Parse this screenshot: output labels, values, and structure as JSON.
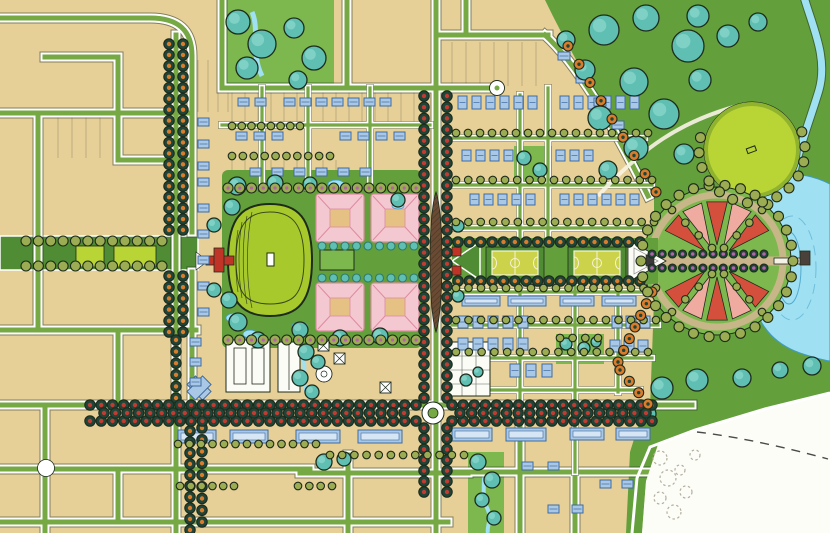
{
  "map": {
    "type": "illustrated-master-plan",
    "features": [
      {
        "name": "street-grid",
        "color": "street"
      },
      {
        "name": "tree-lined-main-avenue",
        "color": "tree_dark"
      },
      {
        "name": "great-lawn-oval",
        "color": "oval"
      },
      {
        "name": "civic-campus-pink-buildings",
        "color": "pink"
      },
      {
        "name": "west-boulevard-green",
        "color": "park_dark"
      },
      {
        "name": "east-mall-sports-courts",
        "color": "court"
      },
      {
        "name": "radial-parterre-garden-circle",
        "color": "garden_red"
      },
      {
        "name": "lake-with-pier",
        "color": "lake"
      },
      {
        "name": "great-park-tree-masses",
        "color": "teal"
      },
      {
        "name": "lawn-circle",
        "color": "lawn"
      },
      {
        "name": "stream",
        "color": "lake"
      },
      {
        "name": "roundabout",
        "color": "street"
      },
      {
        "name": "residential-blocks-blue-buildings",
        "color": "bldg_blue"
      },
      {
        "name": "undeveloped-parcel-pencil-sketch",
        "color": "white_area"
      }
    ]
  },
  "palette": {
    "paper": "#e7d098",
    "street": "#76a844",
    "park": "#63a03c",
    "park_dark": "#4f8c33",
    "park_light": "#7cb84d",
    "lawn": "#b9d435",
    "oval": "#a8c92c",
    "oval_ring": "#8fb22f",
    "teal": "#5fbfb2",
    "teal_dark": "#2c7a6e",
    "ink": "#1e2b1c",
    "tree_dark": "#1f4438",
    "tree_red": "#c23b31",
    "tree_orange": "#d97c2b",
    "tree_olive": "#9cac52",
    "tree_magenta": "#b363a8",
    "bldg_blue": "#a9c8e6",
    "bldg_blue_dark": "#3f6a9e",
    "bldg_blue_light": "#d6e6f5",
    "bldg_white": "#fcfcf6",
    "pink": "#f4c8d1",
    "pink_dark": "#dd8ba0",
    "courtyard": "#e5c183",
    "court": "#ccd24a",
    "cream": "#f6f3da",
    "lake": "#9fe1f2",
    "lake_line": "#3f9cc4",
    "path_tan": "#cbb58a",
    "median": "#6b4a33",
    "gate_red": "#c03427",
    "white_area": "#fdfdf8",
    "sketch": "#b5ae9e",
    "garden_red": "#d5503c",
    "garden_pink": "#efab9f"
  },
  "tree_rows": [
    [
      "ao",
      169,
      44,
      169,
      230,
      18
    ],
    [
      "ao",
      183,
      44,
      183,
      230,
      18
    ],
    [
      "ao",
      169,
      276,
      169,
      332,
      6
    ],
    [
      "ao",
      183,
      276,
      183,
      332,
      6
    ],
    [
      "ao",
      176,
      340,
      176,
      398,
      6
    ],
    [
      "ao",
      190,
      420,
      190,
      530,
      11
    ],
    [
      "ao",
      202,
      428,
      202,
      522,
      9
    ],
    [
      "ar",
      424,
      96,
      424,
      398,
      28
    ],
    [
      "ar",
      447,
      96,
      447,
      398,
      28
    ],
    [
      "ar",
      424,
      428,
      424,
      492,
      7
    ],
    [
      "ar",
      447,
      428,
      447,
      492,
      7
    ],
    [
      "ar",
      90,
      405,
      416,
      405,
      30
    ],
    [
      "ar",
      90,
      421,
      416,
      421,
      30
    ],
    [
      "ar",
      104,
      413,
      404,
      413,
      27
    ],
    [
      "ar",
      452,
      405,
      652,
      405,
      19
    ],
    [
      "ar",
      452,
      421,
      652,
      421,
      19
    ],
    [
      "ar",
      460,
      413,
      646,
      413,
      17
    ],
    [
      "ao",
      458,
      242,
      640,
      242,
      17
    ],
    [
      "ao",
      458,
      281,
      640,
      281,
      17
    ],
    [
      "om",
      228,
      188,
      416,
      188,
      17
    ],
    [
      "om",
      228,
      340,
      416,
      340,
      17
    ],
    [
      "ol",
      26,
      241,
      162,
      241,
      12
    ],
    [
      "ol",
      26,
      266,
      162,
      266,
      12
    ],
    [
      "tm",
      322,
      246,
      414,
      246,
      9
    ],
    [
      "tm",
      322,
      278,
      414,
      278,
      9
    ],
    [
      "mg",
      652,
      254,
      764,
      254,
      12
    ],
    [
      "mg",
      652,
      268,
      764,
      268,
      12
    ],
    [
      "sm",
      232,
      126,
      300,
      126,
      8
    ],
    [
      "sm",
      232,
      156,
      330,
      156,
      10
    ],
    [
      "sm",
      178,
      444,
      316,
      444,
      13
    ],
    [
      "sm",
      330,
      455,
      464,
      455,
      12
    ],
    [
      "sm",
      180,
      486,
      234,
      486,
      6
    ],
    [
      "sm",
      298,
      486,
      332,
      486,
      4
    ],
    [
      "sm",
      456,
      133,
      648,
      133,
      17
    ],
    [
      "sm",
      456,
      180,
      652,
      180,
      17
    ],
    [
      "sm",
      456,
      222,
      654,
      222,
      17
    ],
    [
      "sm",
      456,
      288,
      656,
      288,
      17
    ],
    [
      "sm",
      456,
      320,
      656,
      320,
      17
    ],
    [
      "sm",
      456,
      352,
      648,
      352,
      16
    ],
    [
      "or",
      568,
      46,
      656,
      192,
      9
    ],
    [
      "or",
      652,
      292,
      618,
      362,
      7
    ],
    [
      "or",
      620,
      370,
      648,
      404,
      4
    ],
    [
      "sm",
      672,
      210,
      712,
      248,
      4
    ],
    [
      "sm",
      762,
      210,
      724,
      248,
      4
    ],
    [
      "sm",
      672,
      312,
      712,
      274,
      4
    ],
    [
      "sm",
      762,
      312,
      724,
      274,
      4
    ],
    [
      "sm",
      560,
      338,
      598,
      338,
      4
    ]
  ],
  "tree_rings": [
    [
      "ol",
      717,
      261,
      76,
      30,
      0,
      360
    ],
    [
      "ol",
      752,
      150,
      53,
      14,
      -20,
      210
    ]
  ],
  "tree_clusters": [
    [
      238,
      22,
      12
    ],
    [
      262,
      44,
      14
    ],
    [
      247,
      68,
      11
    ],
    [
      294,
      28,
      10
    ],
    [
      314,
      58,
      12
    ],
    [
      298,
      80,
      9
    ],
    [
      237,
      186,
      9
    ],
    [
      275,
      183,
      8
    ],
    [
      310,
      184,
      7
    ],
    [
      232,
      207,
      8
    ],
    [
      214,
      225,
      7
    ],
    [
      214,
      290,
      7
    ],
    [
      229,
      300,
      8
    ],
    [
      238,
      322,
      9
    ],
    [
      258,
      340,
      8
    ],
    [
      300,
      330,
      8
    ],
    [
      340,
      338,
      8
    ],
    [
      380,
      336,
      8
    ],
    [
      398,
      200,
      7
    ],
    [
      604,
      30,
      15
    ],
    [
      646,
      18,
      13
    ],
    [
      688,
      46,
      16
    ],
    [
      634,
      82,
      14
    ],
    [
      600,
      118,
      12
    ],
    [
      664,
      114,
      15
    ],
    [
      700,
      80,
      11
    ],
    [
      728,
      36,
      11
    ],
    [
      758,
      22,
      9
    ],
    [
      698,
      16,
      11
    ],
    [
      636,
      148,
      12
    ],
    [
      608,
      170,
      9
    ],
    [
      684,
      154,
      10
    ],
    [
      585,
      70,
      10
    ],
    [
      566,
      40,
      9
    ],
    [
      662,
      388,
      11
    ],
    [
      697,
      380,
      11
    ],
    [
      742,
      378,
      9
    ],
    [
      780,
      370,
      8
    ],
    [
      812,
      366,
      9
    ],
    [
      648,
      414,
      8
    ],
    [
      478,
      462,
      8
    ],
    [
      492,
      480,
      8
    ],
    [
      482,
      500,
      7
    ],
    [
      494,
      518,
      7
    ],
    [
      324,
      462,
      8
    ],
    [
      344,
      459,
      7
    ],
    [
      306,
      352,
      8
    ],
    [
      318,
      362,
      7
    ],
    [
      300,
      378,
      8
    ],
    [
      312,
      392,
      7
    ],
    [
      466,
      380,
      6
    ],
    [
      478,
      372,
      5
    ],
    [
      524,
      158,
      7
    ],
    [
      540,
      170,
      7
    ],
    [
      566,
      344,
      6
    ],
    [
      584,
      348,
      6
    ],
    [
      596,
      342,
      5
    ],
    [
      458,
      226,
      6
    ],
    [
      458,
      296,
      6
    ]
  ],
  "houses": [
    {
      "x": 284,
      "y": 98,
      "n": 7,
      "dx": 16
    },
    {
      "x": 238,
      "y": 98,
      "n": 2,
      "dx": 17
    },
    {
      "x": 236,
      "y": 132,
      "n": 3,
      "dx": 18
    },
    {
      "x": 340,
      "y": 132,
      "n": 4,
      "dx": 18
    },
    {
      "x": 250,
      "y": 168,
      "n": 6,
      "dx": 22
    },
    {
      "x": 198,
      "y": 118,
      "n": 3,
      "dy": 22
    },
    {
      "x": 198,
      "y": 178,
      "n": 6,
      "dy": 26
    },
    {
      "x": 190,
      "y": 338,
      "n": 3,
      "dy": 20
    },
    {
      "x": 458,
      "y": 96,
      "n": 6,
      "dx": 14,
      "w": 9,
      "h": 13
    },
    {
      "x": 560,
      "y": 96,
      "n": 6,
      "dx": 14,
      "w": 9,
      "h": 13
    },
    {
      "x": 462,
      "y": 150,
      "n": 4,
      "dx": 14,
      "w": 9,
      "h": 11
    },
    {
      "x": 556,
      "y": 150,
      "n": 3,
      "dx": 14,
      "w": 9,
      "h": 11
    },
    {
      "x": 470,
      "y": 194,
      "n": 5,
      "dx": 14,
      "w": 9,
      "h": 11
    },
    {
      "x": 560,
      "y": 194,
      "n": 6,
      "dx": 14,
      "w": 9,
      "h": 11
    },
    {
      "x": 558,
      "y": 52,
      "n": 5,
      "dx": 18,
      "dy": 23,
      "w": 12,
      "h": 8
    },
    {
      "x": 462,
      "y": 296,
      "n": 2,
      "dx": 46,
      "w": 38,
      "h": 10,
      "t": "B"
    },
    {
      "x": 560,
      "y": 296,
      "n": 2,
      "dx": 42,
      "w": 34,
      "h": 10,
      "t": "B"
    },
    {
      "x": 458,
      "y": 316,
      "n": 5,
      "dx": 15,
      "w": 10,
      "h": 12
    },
    {
      "x": 458,
      "y": 338,
      "n": 5,
      "dx": 15,
      "w": 10,
      "h": 12
    },
    {
      "x": 510,
      "y": 364,
      "n": 3,
      "dx": 16,
      "w": 10,
      "h": 13
    },
    {
      "x": 612,
      "y": 316,
      "n": 3,
      "dx": 14,
      "w": 10,
      "h": 12
    },
    {
      "x": 610,
      "y": 340,
      "n": 3,
      "dx": 14,
      "w": 10,
      "h": 12
    },
    {
      "x": 178,
      "y": 430,
      "n": 2,
      "dx": 52,
      "w": 38,
      "h": 13,
      "t": "B"
    },
    {
      "x": 296,
      "y": 430,
      "n": 2,
      "dx": 62,
      "w": 44,
      "h": 13,
      "t": "B"
    },
    {
      "x": 452,
      "y": 428,
      "n": 2,
      "dx": 54,
      "w": 40,
      "h": 13,
      "t": "B"
    },
    {
      "x": 570,
      "y": 428,
      "n": 2,
      "dx": 46,
      "w": 34,
      "h": 12,
      "t": "B"
    },
    {
      "x": 522,
      "y": 462,
      "n": 2,
      "dx": 26
    },
    {
      "x": 548,
      "y": 505,
      "n": 2,
      "dx": 24
    },
    {
      "x": 600,
      "y": 480,
      "n": 2,
      "dx": 22
    }
  ],
  "lot_lines": [
    [
      232,
      420,
      92,
      32,
      13
    ],
    [
      232,
      346,
      160,
      26,
      13
    ],
    [
      58,
      114,
      114,
      44,
      14
    ],
    [
      198,
      230,
      60,
      52,
      10
    ],
    [
      452,
      540,
      42,
      44,
      14
    ]
  ],
  "ponds": [
    [
      236,
      318,
      10,
      5
    ],
    [
      250,
      334,
      7,
      4
    ],
    [
      300,
      326,
      8,
      4
    ],
    [
      336,
      184,
      8,
      4
    ],
    [
      398,
      206,
      6,
      3
    ]
  ],
  "sketch_trees": [
    [
      660,
      458,
      7
    ],
    [
      668,
      478,
      8
    ],
    [
      660,
      498,
      6
    ],
    [
      674,
      512,
      7
    ],
    [
      686,
      492,
      6
    ],
    [
      680,
      470,
      5
    ],
    [
      695,
      455,
      5
    ]
  ],
  "garden": {
    "cx": 717,
    "cy": 261,
    "r1": 16,
    "r2": 60,
    "fans": [
      {
        "a1": -152,
        "a2": -28,
        "n": 5
      },
      {
        "a1": 28,
        "a2": 152,
        "n": 5
      }
    ],
    "fills": [
      "garden_red",
      "garden_pink"
    ]
  }
}
